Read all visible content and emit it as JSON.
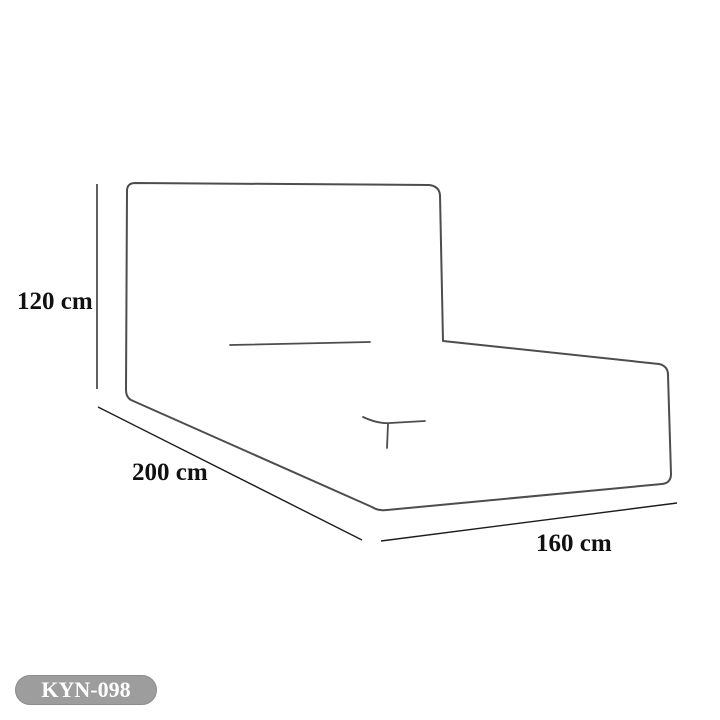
{
  "diagram": {
    "product_code": "KYN-098",
    "dimensions": {
      "height_label": "120 cm",
      "length_label": "200 cm",
      "width_label": "160 cm"
    },
    "colors": {
      "outline": "#4d4d4d",
      "dimension_line": "#1c1c1c",
      "label_text": "#111111",
      "badge_bg": "#9d9d9d",
      "badge_border": "#8c8c8c",
      "badge_text": "#ffffff",
      "background": "#ffffff"
    }
  }
}
